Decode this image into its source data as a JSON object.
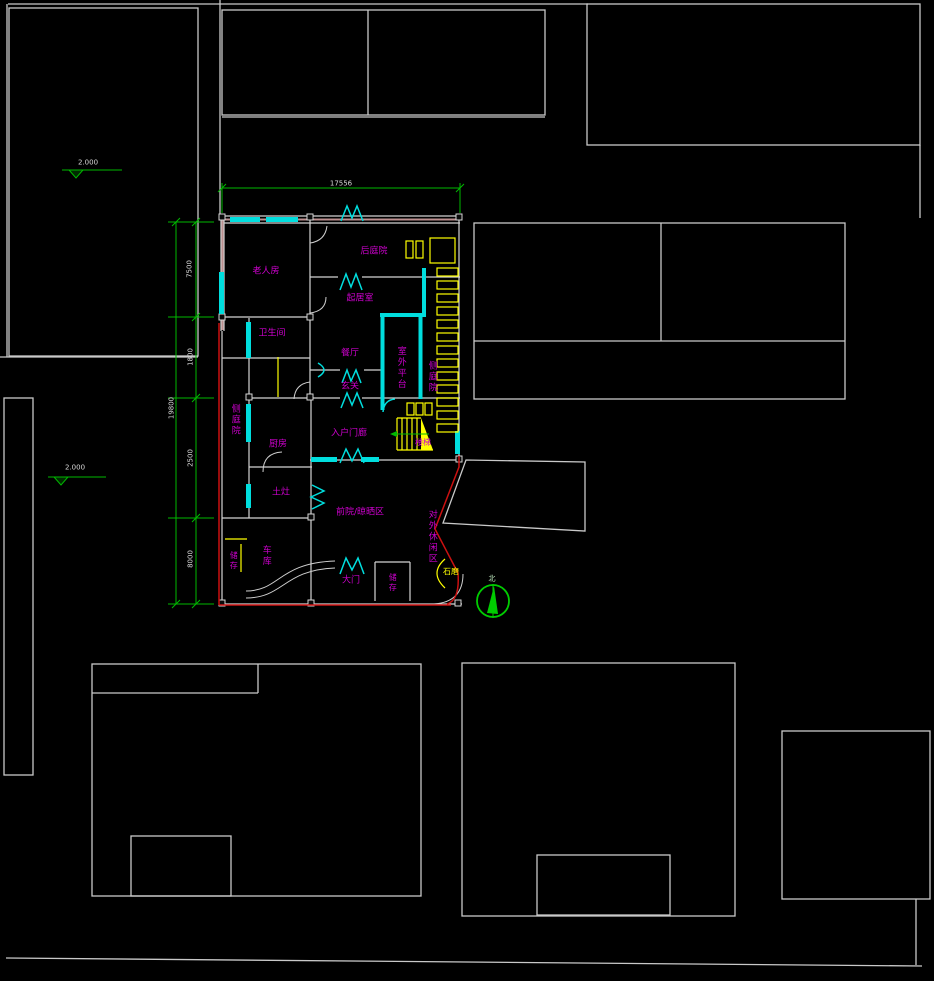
{
  "drawing": {
    "type": "cad-site-floor-plan",
    "background": "#000000"
  },
  "colors": {
    "site_outline": "#c9c9c9",
    "house_wall": "#d4d4d4",
    "wall_accent": "#bc8f8f",
    "window": "#00dede",
    "room_label": "#cc00cc",
    "furniture": "#ffff00",
    "dimension_line": "#00b800",
    "site_boundary_red": "#cc1111"
  },
  "plan": {
    "rooms": {
      "elder_room": {
        "label": "老人房"
      },
      "rear_courtyard": {
        "label": "后庭院"
      },
      "living_room": {
        "label": "起居室"
      },
      "bathroom": {
        "label": "卫生间"
      },
      "dining_room": {
        "label": "餐厅"
      },
      "outdoor_platform": {
        "label": "室外平台"
      },
      "side_courtyard_right": {
        "label": "侧庭院"
      },
      "side_courtyard_left": {
        "label": "侧庭院"
      },
      "foyer": {
        "label": "玄关"
      },
      "entry_porch": {
        "label": "入户门廊"
      },
      "kitchen": {
        "label": "厨房"
      },
      "stairs": {
        "label": "楼梯"
      },
      "earthen_stove": {
        "label": "土灶"
      },
      "front_yard": {
        "label": "前院/晾晒区"
      },
      "leisure_area": {
        "label": "对外休闲区"
      },
      "storage_west": {
        "label": "储存"
      },
      "garage": {
        "label": "车库"
      },
      "main_gate": {
        "label": "大门"
      },
      "storage_south": {
        "label": "储存"
      },
      "stone_mill": {
        "label": "石磨"
      }
    }
  },
  "dimensions": {
    "top_total": "17556",
    "left_segments": [
      "7500",
      "1800",
      "2500",
      "8000"
    ],
    "left_total": "19800"
  },
  "elevation_markers": [
    {
      "value": "2.000"
    },
    {
      "value": "2.000"
    }
  ],
  "compass": {
    "north_label": "北"
  }
}
